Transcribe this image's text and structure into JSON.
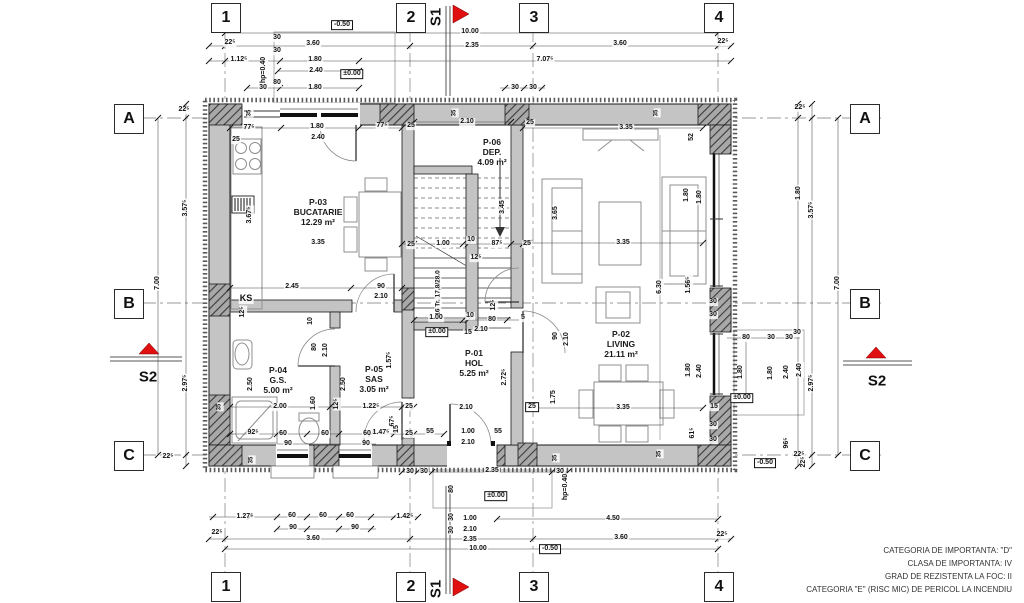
{
  "sections": {
    "s1_label": "S1",
    "s2_label": "S2",
    "flag_color": "#e01010"
  },
  "grid_axes": {
    "columns": [
      {
        "label": "1",
        "x": 225
      },
      {
        "label": "2",
        "x": 410
      },
      {
        "label": "3",
        "x": 533
      },
      {
        "label": "4",
        "x": 718
      }
    ],
    "rows": [
      {
        "label": "A",
        "y": 118
      },
      {
        "label": "B",
        "y": 303
      },
      {
        "label": "C",
        "y": 455
      }
    ]
  },
  "rooms": [
    {
      "id": "P-03",
      "name": "BUCATARIE",
      "area": "12.29 m²",
      "x": 318,
      "y": 212
    },
    {
      "id": "P-06",
      "name": "DEP.",
      "area": "4.09 m²",
      "x": 492,
      "y": 152
    },
    {
      "id": "P-02",
      "name": "LIVING",
      "area": "21.11 m²",
      "x": 621,
      "y": 344
    },
    {
      "id": "P-01",
      "name": "HOL",
      "area": "5.25 m²",
      "x": 474,
      "y": 363
    },
    {
      "id": "P-05",
      "name": "SAS",
      "area": "3.05 m²",
      "x": 374,
      "y": 379
    },
    {
      "id": "P-04",
      "name": "G.S.",
      "area": "5.00 m²",
      "x": 278,
      "y": 380
    }
  ],
  "notes": [
    "CATEGORIA DE IMPORTANTA: \"D\"",
    "CLASA DE IMPORTANTA: IV",
    "GRAD DE REZISTENTA LA FOC: II",
    "CATEGORIA \"E\" (RISC MIC) DE PERICOL LA INCENDIU"
  ],
  "dimensions": [
    {
      "t": "-0.50",
      "x": 342,
      "y": 25,
      "b": true
    },
    {
      "t": "10.00",
      "x": 470,
      "y": 32
    },
    {
      "t": "2.35",
      "x": 472,
      "y": 46
    },
    {
      "t": "22⁵",
      "x": 230,
      "y": 43
    },
    {
      "t": "3.60",
      "x": 313,
      "y": 44
    },
    {
      "t": "3.60",
      "x": 620,
      "y": 44
    },
    {
      "t": "22⁵",
      "x": 723,
      "y": 42
    },
    {
      "t": "1.12⁵",
      "x": 239,
      "y": 60
    },
    {
      "t": "1.80",
      "x": 315,
      "y": 60
    },
    {
      "t": "7.07⁵",
      "x": 545,
      "y": 60
    },
    {
      "t": "2.40",
      "x": 316,
      "y": 71
    },
    {
      "t": "±0.00",
      "x": 352,
      "y": 74,
      "b": true
    },
    {
      "t": "30",
      "x": 277,
      "y": 38
    },
    {
      "t": "30",
      "x": 277,
      "y": 51
    },
    {
      "t": "80",
      "x": 277,
      "y": 83
    },
    {
      "t": "hp=0.40",
      "x": 264,
      "y": 70,
      "r": -90
    },
    {
      "t": "30",
      "x": 263,
      "y": 88
    },
    {
      "t": "1.80",
      "x": 315,
      "y": 88
    },
    {
      "t": "30",
      "x": 515,
      "y": 88
    },
    {
      "t": "30",
      "x": 533,
      "y": 88
    },
    {
      "t": "22⁵",
      "x": 184,
      "y": 110
    },
    {
      "t": "3.57⁵",
      "x": 186,
      "y": 208,
      "r": -90
    },
    {
      "t": "7.00",
      "x": 158,
      "y": 283,
      "r": -90
    },
    {
      "t": "2.97⁵",
      "x": 186,
      "y": 383,
      "r": -90
    },
    {
      "t": "22⁵",
      "x": 168,
      "y": 457
    },
    {
      "t": "22⁵",
      "x": 800,
      "y": 108
    },
    {
      "t": "1.80",
      "x": 799,
      "y": 193,
      "r": -90
    },
    {
      "t": "3.57⁵",
      "x": 812,
      "y": 210,
      "r": -90
    },
    {
      "t": "7.00",
      "x": 838,
      "y": 283,
      "r": -90
    },
    {
      "t": "30",
      "x": 797,
      "y": 333
    },
    {
      "t": "2.40",
      "x": 800,
      "y": 370,
      "r": -90
    },
    {
      "t": "2.97⁵",
      "x": 812,
      "y": 383,
      "r": -90
    },
    {
      "t": "22⁵",
      "x": 799,
      "y": 455
    },
    {
      "t": "30",
      "x": 713,
      "y": 302
    },
    {
      "t": "30",
      "x": 713,
      "y": 315
    },
    {
      "t": "80",
      "x": 746,
      "y": 338
    },
    {
      "t": "30",
      "x": 771,
      "y": 338
    },
    {
      "t": "30",
      "x": 789,
      "y": 338
    },
    {
      "t": "1.80",
      "x": 741,
      "y": 372,
      "r": -90
    },
    {
      "t": "1.80",
      "x": 771,
      "y": 373,
      "r": -90
    },
    {
      "t": "2.40",
      "x": 787,
      "y": 372,
      "r": -90
    },
    {
      "t": "±0.00",
      "x": 742,
      "y": 398,
      "b": true
    },
    {
      "t": "15",
      "x": 714,
      "y": 407
    },
    {
      "t": "30",
      "x": 713,
      "y": 425
    },
    {
      "t": "30",
      "x": 713,
      "y": 440
    },
    {
      "t": "96⁵",
      "x": 787,
      "y": 443,
      "r": -90
    },
    {
      "t": "-0.50",
      "x": 765,
      "y": 463,
      "b": true
    },
    {
      "t": "22⁵",
      "x": 804,
      "y": 462,
      "r": -90
    },
    {
      "t": "4.50",
      "x": 613,
      "y": 519
    },
    {
      "t": "3.60",
      "x": 621,
      "y": 538
    },
    {
      "t": "22⁵",
      "x": 722,
      "y": 535
    },
    {
      "t": "30",
      "x": 410,
      "y": 472
    },
    {
      "t": "30",
      "x": 424,
      "y": 472
    },
    {
      "t": "2.35",
      "x": 492,
      "y": 471
    },
    {
      "t": "30",
      "x": 560,
      "y": 472
    },
    {
      "t": "80",
      "x": 452,
      "y": 489,
      "r": -90
    },
    {
      "t": "±0.00",
      "x": 496,
      "y": 496,
      "b": true
    },
    {
      "t": "hp=0.40",
      "x": 566,
      "y": 487,
      "r": -90
    },
    {
      "t": "30",
      "x": 452,
      "y": 517,
      "r": -90
    },
    {
      "t": "1.00",
      "x": 470,
      "y": 519
    },
    {
      "t": "30",
      "x": 452,
      "y": 530,
      "r": -90
    },
    {
      "t": "2.10",
      "x": 470,
      "y": 530
    },
    {
      "t": "2.35",
      "x": 470,
      "y": 540
    },
    {
      "t": "10.00",
      "x": 478,
      "y": 549
    },
    {
      "t": "-0.50",
      "x": 550,
      "y": 549,
      "b": true
    },
    {
      "t": "1.27⁵",
      "x": 245,
      "y": 517
    },
    {
      "t": "60",
      "x": 292,
      "y": 516
    },
    {
      "t": "60",
      "x": 323,
      "y": 516
    },
    {
      "t": "60",
      "x": 350,
      "y": 516
    },
    {
      "t": "90",
      "x": 293,
      "y": 528
    },
    {
      "t": "90",
      "x": 355,
      "y": 528
    },
    {
      "t": "3.60",
      "x": 313,
      "y": 539
    },
    {
      "t": "22⁵",
      "x": 217,
      "y": 533
    },
    {
      "t": "1.42⁵",
      "x": 405,
      "y": 517
    },
    {
      "t": "77⁵",
      "x": 249,
      "y": 128
    },
    {
      "t": "25",
      "x": 236,
      "y": 140
    },
    {
      "t": "1.80",
      "x": 317,
      "y": 127
    },
    {
      "t": "2.40",
      "x": 318,
      "y": 138
    },
    {
      "t": "77⁵",
      "x": 382,
      "y": 126
    },
    {
      "t": "25",
      "x": 411,
      "y": 126
    },
    {
      "t": "2.10",
      "x": 467,
      "y": 122
    },
    {
      "t": "25",
      "x": 530,
      "y": 123
    },
    {
      "t": "3.35",
      "x": 626,
      "y": 128
    },
    {
      "t": "52",
      "x": 692,
      "y": 137,
      "r": -90
    },
    {
      "t": "35",
      "x": 250,
      "y": 113,
      "r": -90,
      "s": 6
    },
    {
      "t": "35",
      "x": 455,
      "y": 113,
      "r": -90,
      "s": 6
    },
    {
      "t": "35",
      "x": 657,
      "y": 113,
      "r": -90,
      "s": 6
    },
    {
      "t": "35",
      "x": 220,
      "y": 407,
      "r": -90,
      "s": 6
    },
    {
      "t": "35",
      "x": 252,
      "y": 460,
      "r": -90,
      "s": 6
    },
    {
      "t": "35",
      "x": 556,
      "y": 458,
      "r": -90,
      "s": 6
    },
    {
      "t": "35",
      "x": 660,
      "y": 454,
      "r": -90,
      "s": 6
    },
    {
      "t": "3.35",
      "x": 318,
      "y": 243
    },
    {
      "t": "2.45",
      "x": 292,
      "y": 287
    },
    {
      "t": "90",
      "x": 381,
      "y": 287
    },
    {
      "t": "2.10",
      "x": 381,
      "y": 297
    },
    {
      "t": "3.67⁵",
      "x": 250,
      "y": 215,
      "r": -90
    },
    {
      "t": "KS",
      "x": 246,
      "y": 299,
      "s": 9,
      "n": "ks-label"
    },
    {
      "t": "16 Tr. 17,8/28.0",
      "x": 438,
      "y": 293,
      "r": -90,
      "s": 6.5,
      "n": "stair-label"
    },
    {
      "t": "3.45",
      "x": 503,
      "y": 207,
      "r": -90
    },
    {
      "t": "3.65",
      "x": 556,
      "y": 213,
      "r": -90
    },
    {
      "t": "87⁵",
      "x": 497,
      "y": 244
    },
    {
      "t": "25",
      "x": 411,
      "y": 245
    },
    {
      "t": "1.00",
      "x": 443,
      "y": 244
    },
    {
      "t": "10",
      "x": 471,
      "y": 240
    },
    {
      "t": "25",
      "x": 527,
      "y": 244
    },
    {
      "t": "12⁵",
      "x": 476,
      "y": 258
    },
    {
      "t": "1.00",
      "x": 436,
      "y": 318
    },
    {
      "t": "10",
      "x": 470,
      "y": 316
    },
    {
      "t": "80",
      "x": 492,
      "y": 320
    },
    {
      "t": "5",
      "x": 523,
      "y": 318
    },
    {
      "t": "±0.00",
      "x": 437,
      "y": 332,
      "b": true
    },
    {
      "t": "15",
      "x": 468,
      "y": 333
    },
    {
      "t": "2.10",
      "x": 481,
      "y": 330
    },
    {
      "t": "12⁵",
      "x": 494,
      "y": 305,
      "r": -90
    },
    {
      "t": "90",
      "x": 556,
      "y": 336,
      "r": -90
    },
    {
      "t": "2.10",
      "x": 567,
      "y": 339,
      "r": -90
    },
    {
      "t": "12⁵",
      "x": 243,
      "y": 312,
      "r": -90
    },
    {
      "t": "10",
      "x": 311,
      "y": 321,
      "r": -90
    },
    {
      "t": "80",
      "x": 315,
      "y": 347,
      "r": -90
    },
    {
      "t": "2.10",
      "x": 326,
      "y": 350,
      "r": -90
    },
    {
      "t": "2.50",
      "x": 251,
      "y": 384,
      "r": -90
    },
    {
      "t": "2.00",
      "x": 280,
      "y": 407
    },
    {
      "t": "1.60",
      "x": 314,
      "y": 403,
      "r": -90
    },
    {
      "t": "12⁵",
      "x": 337,
      "y": 404,
      "r": -90
    },
    {
      "t": "2.50",
      "x": 344,
      "y": 384,
      "r": -90
    },
    {
      "t": "1.22⁵",
      "x": 371,
      "y": 407
    },
    {
      "t": "1.57⁵",
      "x": 390,
      "y": 360,
      "r": -90
    },
    {
      "t": "67⁵",
      "x": 393,
      "y": 421,
      "r": -90
    },
    {
      "t": "25",
      "x": 409,
      "y": 407
    },
    {
      "t": "92⁵",
      "x": 253,
      "y": 433
    },
    {
      "t": "60",
      "x": 283,
      "y": 434
    },
    {
      "t": "60",
      "x": 325,
      "y": 434
    },
    {
      "t": "60",
      "x": 367,
      "y": 434
    },
    {
      "t": "90",
      "x": 288,
      "y": 444
    },
    {
      "t": "90",
      "x": 366,
      "y": 444
    },
    {
      "t": "1.47⁵",
      "x": 381,
      "y": 433
    },
    {
      "t": "15",
      "x": 397,
      "y": 429,
      "r": -90
    },
    {
      "t": "25",
      "x": 409,
      "y": 434
    },
    {
      "t": "2.72⁵",
      "x": 505,
      "y": 377,
      "r": -90
    },
    {
      "t": "25",
      "x": 532,
      "y": 407,
      "b": true
    },
    {
      "t": "1.75",
      "x": 554,
      "y": 397,
      "r": -90
    },
    {
      "t": "2.10",
      "x": 466,
      "y": 408
    },
    {
      "t": "55",
      "x": 430,
      "y": 432
    },
    {
      "t": "1.00",
      "x": 468,
      "y": 432
    },
    {
      "t": "55",
      "x": 498,
      "y": 432
    },
    {
      "t": "2.10",
      "x": 468,
      "y": 443
    },
    {
      "t": "3.35",
      "x": 623,
      "y": 408
    },
    {
      "t": "6.30",
      "x": 660,
      "y": 287,
      "r": -90
    },
    {
      "t": "1.56⁵",
      "x": 689,
      "y": 285,
      "r": -90
    },
    {
      "t": "1.80",
      "x": 687,
      "y": 195,
      "r": -90
    },
    {
      "t": "1.80",
      "x": 700,
      "y": 197,
      "r": -90
    },
    {
      "t": "3.35",
      "x": 623,
      "y": 243
    },
    {
      "t": "61⁵",
      "x": 693,
      "y": 433,
      "r": -90
    },
    {
      "t": "1.80",
      "x": 689,
      "y": 370,
      "r": -90
    },
    {
      "t": "2.40",
      "x": 700,
      "y": 371,
      "r": -90
    }
  ]
}
